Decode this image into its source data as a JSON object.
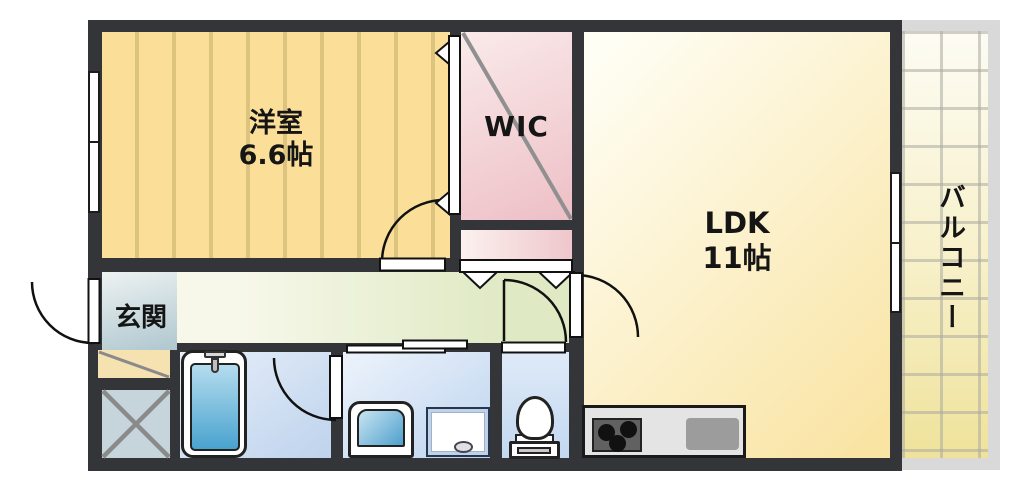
{
  "floorplan": {
    "rooms": {
      "western_room": {
        "name": "洋室",
        "size": "6.6帖"
      },
      "wic": {
        "name": "WIC"
      },
      "ldk": {
        "name": "LDK",
        "size": "11帖"
      },
      "balcony": {
        "name": "バルコニー"
      },
      "entrance": {
        "name": "玄関"
      }
    },
    "colors": {
      "wall": "#343539",
      "western_room_floor": "#FBDF98",
      "wic_floor": "#EDBFC6",
      "ldk_floor": "#F9E4A4",
      "hallway_floor": "#DFE9C3",
      "entrance_floor": "#AFC7CF",
      "bathroom_floor": "#BED3ED",
      "balcony_floor": "#EFE29B",
      "bathtub_water": "#49A3CF"
    }
  }
}
